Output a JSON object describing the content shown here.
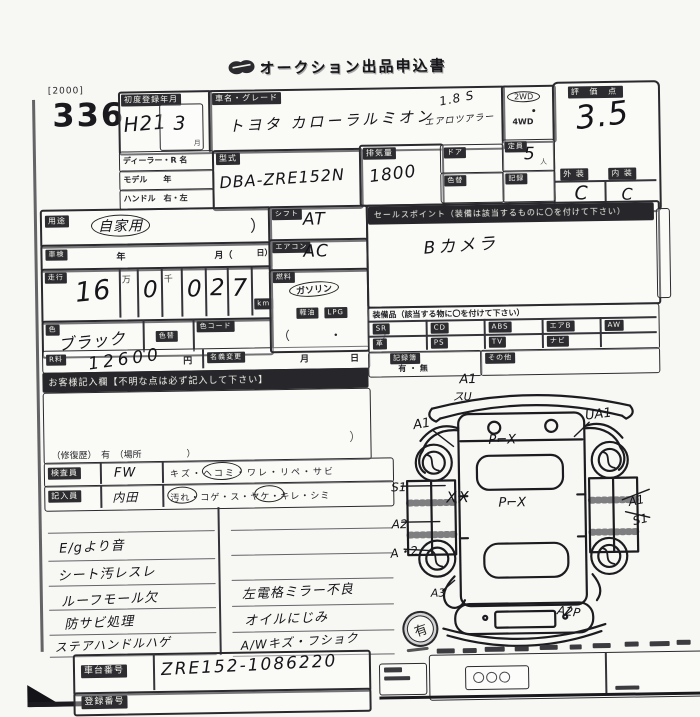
{
  "page": {
    "doc_code": "[2000]",
    "lot_number": "336",
    "title": "オークション出品申込書"
  },
  "reg": {
    "label": "初度登録年月",
    "year": "H21",
    "month": "3",
    "month_unit": "月"
  },
  "vehicle": {
    "name_label": "車名・グレード",
    "name": "トヨタ カローラルミオン",
    "grade1": "1.8 S",
    "grade2": "エアロツアラー",
    "type_label": "型式",
    "type": "DBA-ZRE152N",
    "disp_label": "排気量",
    "disp": "1800",
    "door_label": "ドア",
    "cap_label": "定員",
    "cap": "5",
    "cap_unit": "人",
    "colorchg_label": "色替",
    "record_label": "記録",
    "dealer_label": "ディーラー・R 名",
    "model_label": "モデル　　年",
    "handle_label": "ハンドル　右・左",
    "drive1": "2WD",
    "drive2": "4WD"
  },
  "score": {
    "label": "評 価 点",
    "value": "3.5",
    "ext_label": "外 装",
    "int_label": "内 装",
    "ext": "C",
    "int": "C"
  },
  "usage": {
    "label": "用途",
    "value": "自家用",
    "paren": "）"
  },
  "shaken": {
    "label": "車検",
    "year": "年",
    "month": "月（",
    "day": "日）"
  },
  "mileage": {
    "label": "走行",
    "v1": "16",
    "man": "万",
    "v2": "0",
    "sen": "千",
    "v3": "0",
    "v4": "2",
    "v5": "7",
    "unit": "km"
  },
  "color": {
    "label": "色",
    "value": "ブラック",
    "chg_label": "色替",
    "code_label": "色コード"
  },
  "fee": {
    "label": "R料",
    "value": "12600",
    "yen": "円",
    "transfer_label": "名義変更",
    "month": "月",
    "day": "日"
  },
  "notice": "お客様記入欄【不明な点は必ず記入して下さい】",
  "shift": {
    "label": "シフト",
    "value": "AT"
  },
  "aircon": {
    "label": "エアコン",
    "value": "AC"
  },
  "fuel": {
    "label": "燃料",
    "opt1": "ガソリン",
    "opt2": "軽油",
    "opt3": "LPG",
    "paren": "（　・　）"
  },
  "sales": {
    "header": "セールスポイント（装備は該当するものに〇を付けて下さい）",
    "value": "Bカメラ"
  },
  "equip": {
    "header": "装備品（該当する物に〇を付けて下さい）",
    "row1": [
      "SR",
      "CD",
      "ABS",
      "エアB",
      "AW"
    ],
    "row2": [
      "革",
      "PS",
      "TV",
      "ナビ"
    ],
    "record_label": "記録簿",
    "record_opts": "有 ・ 無",
    "other_label": "その他"
  },
  "repair": {
    "note": "（修復歴）　有　（場所　　　　　）",
    "paren": "）"
  },
  "staff": {
    "inspector_label": "検査員",
    "inspector": "FW",
    "inspector_opts": "キズ・ヘコミ・ワレ・リペ・サビ",
    "writer_label": "記入員",
    "writer": "内田",
    "writer_opts": "汚れ・コゲ・ス・ヤケ・キレ・シミ"
  },
  "notes": {
    "left": [
      "E/gより音",
      "シート汚レスレ",
      "ルーフモール欠",
      "防サビ処理",
      "ステアハンドルハゲ"
    ],
    "right": [
      "左電格ミラー不良",
      "オイルにじみ",
      "A/Wキズ・フショク"
    ]
  },
  "chassis": {
    "label": "車台番号",
    "value": "ZRE152-1086220",
    "reg_label": "登録番号"
  },
  "stamp": {
    "text": "有"
  },
  "diagram": {
    "marks": [
      "A1",
      "スU",
      "A1",
      "UA1",
      "P⌐X",
      "S1",
      "XX",
      "P⌐X",
      "A1",
      "A2",
      "S1",
      "A・2",
      "A3",
      "A2P"
    ]
  }
}
